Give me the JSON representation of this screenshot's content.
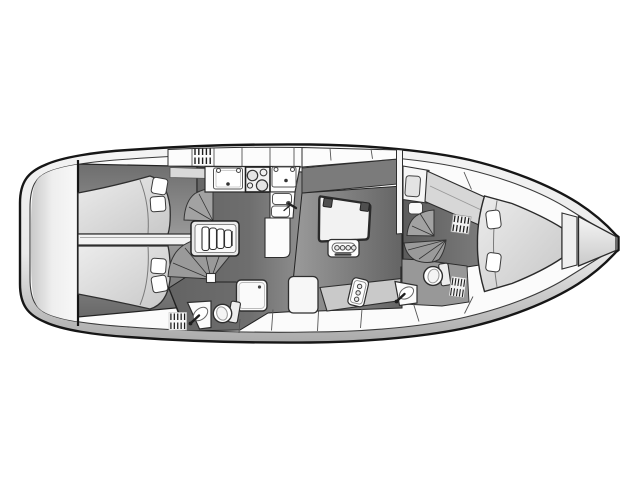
{
  "diagram": {
    "kind": "sailing-yacht-interior-deck-plan",
    "view": "top-down",
    "bow_direction": "right",
    "visible_text": "none"
  },
  "colors": {
    "background": "#ffffff",
    "outline": "#161616",
    "hull_top": "#f4f4f4",
    "hull_mid": "#e9e9e9",
    "hull_bottom": "#aaaaaa",
    "deck": "#fbfbfb",
    "transom_shade": "#c9c9c9",
    "floor_dark": "#5c5c5c",
    "floor_mid": "#6e6e6e",
    "floor_light": "#9c9c9c",
    "settee_port": "#7b7b7b",
    "settee_starboard": "#c9c9c9",
    "door_fan": "#9a9a9a",
    "door_fan_small": "#a2a2a2",
    "mattress_light": "#ececec",
    "mattress_dark": "#c8c8c8",
    "shelf": "#d9d9d9",
    "furniture": "#fcfcfc",
    "fixture_fill": "#f2f2f2",
    "head_floor": "#989898",
    "stroke_detail": "#2e2e2e"
  },
  "compartments": [
    {
      "id": "transom",
      "label": "stern transom platform",
      "features": [
        "rounded stern"
      ]
    },
    {
      "id": "aft-cabin",
      "label": "aft master cabin",
      "features": [
        "transverse double berth",
        "4 pillows",
        "center beam",
        "shelf"
      ]
    },
    {
      "id": "companionway",
      "label": "companionway",
      "features": [
        "4-step ladder",
        "door swing arc",
        "door hinge post"
      ]
    },
    {
      "id": "galley",
      "label": "galley",
      "features": [
        "overhead lockers",
        "vent grate",
        "counter sink x2",
        "2-burner stove",
        "double basin sink",
        "faucet",
        "L-shaped counter"
      ]
    },
    {
      "id": "aft-head",
      "label": "aft head",
      "features": [
        "toilet",
        "vanity sink with faucet",
        "shower pan with drain",
        "floor grate"
      ]
    },
    {
      "id": "salon",
      "label": "salon",
      "features": [
        "folding table with 2 hinge blocks",
        "4-ring bottle holder",
        "port settee",
        "starboard settee",
        "3-ring bottle rack",
        "seat"
      ]
    },
    {
      "id": "forward-cabin",
      "label": "forward cabin",
      "features": [
        "port seat with cushion",
        "step stool",
        "side berth band",
        "vent grate",
        "door swing arcs"
      ]
    },
    {
      "id": "forward-head",
      "label": "forward head",
      "features": [
        "toilet",
        "vanity sink with faucet",
        "shower grate"
      ]
    },
    {
      "id": "v-berth",
      "label": "V-berth forward",
      "features": [
        "double berth",
        "2 pillows",
        "mattress seam"
      ]
    },
    {
      "id": "bow",
      "label": "bow",
      "features": [
        "foot bulkhead",
        "anchor locker triangle",
        "flat nose tip"
      ]
    }
  ],
  "counts": {
    "ladder_steps": 4,
    "aft_berth_pillows": 4,
    "v_berth_pillows": 2,
    "stove_burners_large": 2,
    "stove_burners_small": 2,
    "galley_sinks": 4,
    "bottle_holder_rings": 4,
    "bottle_rack_rings": 3,
    "toilets": 2,
    "vanity_sinks": 2,
    "vent_grates": 4,
    "door_swing_arcs": 4
  }
}
